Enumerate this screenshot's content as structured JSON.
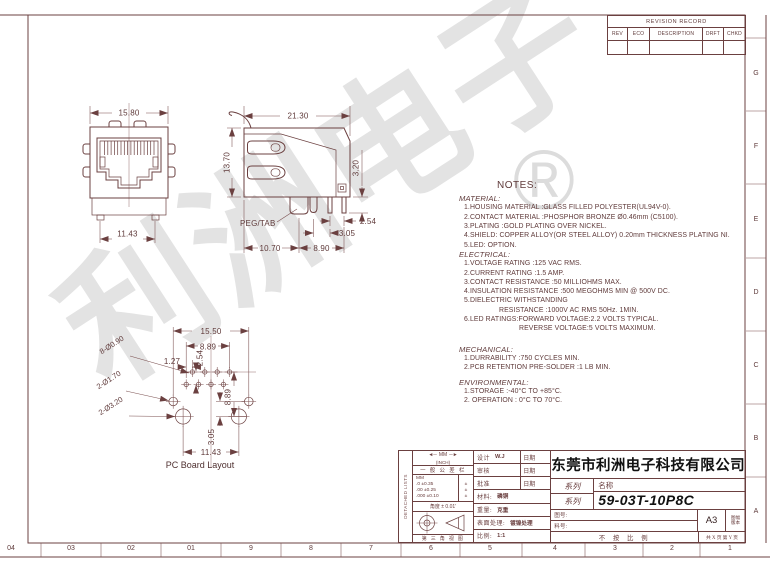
{
  "watermark": {
    "text": "利洲电子",
    "registered": "®",
    "color": "#e3e3e3"
  },
  "colors": {
    "line": "#6b4040",
    "black_text": "#111111",
    "watermark": "#e3e3e3"
  },
  "revision_table": {
    "title": "REVISION RECORD",
    "columns": [
      "REV",
      "ECO",
      "DESCRIPTION",
      "DRFT",
      "CHKD"
    ]
  },
  "border": {
    "bottom_labels": [
      "04",
      "03",
      "02",
      "01",
      "9",
      "8",
      "7",
      "6",
      "5",
      "4",
      "3",
      "2",
      "1"
    ],
    "right_labels": [
      "G",
      "F",
      "E",
      "D",
      "C",
      "B",
      "A"
    ]
  },
  "front_view": {
    "dim_width": "15.80",
    "dim_pin_span": "11.43"
  },
  "side_view": {
    "dim_depth": "21.30",
    "dim_height": "13.70",
    "dim_pin_length": "3.20",
    "dim_pin_pitch": "2.54",
    "dim_peg_to_pin": "3.05",
    "dim_peg_offset": "10.70",
    "dim_pin_row": "8.90",
    "peg_label": "PEG/TAB"
  },
  "pcb_layout": {
    "caption": "PC Board Layout",
    "dim_peg_spacing": "15.50",
    "dim_pin_row_width": "8.89",
    "dim_pin_offset": "1.27",
    "dim_row_pitch": "2.54",
    "dim_row_to_hole": "8.89",
    "dim_hole_gap": "3.05",
    "dim_shield_spacing": "11.43",
    "label_pin_holes": "8-Ø0.90",
    "label_peg_holes": "2-Ø1.70",
    "label_shield_holes": "2-Ø3.20"
  },
  "notes": {
    "title": "NOTES:",
    "material_heading": "MATERIAL:",
    "material_items": [
      "1.HOUSING  MATERIAL  :GLASS  FILLED  POLYESTER(UL94V-0).",
      "2.CONTACT  MATERIAL   :PHOSPHOR  BRONZE  Ø0.46mm  (C5100).",
      "3.PLATING  :GOLD  PLATING  OVER  NICKEL.",
      "4.SHIELD: COPPER  ALLOY(OR  STEEL  ALLOY)  0.20mm  THICKNESS  PLATING  NI.",
      "5.LED: OPTION."
    ],
    "electrical_heading": "ELECTRICAL:",
    "electrical_items": [
      "1.VOLTAGE  RATING  :125  VAC  RMS.",
      "2.CURRENT  RATING  :1.5  AMP.",
      "3.CONTACT  RESISTANCE  :50  MILLIOHMS  MAX.",
      "4.INSULATION  RESISTANCE    :500  MEGOHMS  MIN  @  500V  DC.",
      "5.DIELECTRIC  WITHSTANDING",
      "RESISTANCE  :1000V  AC  RMS  50Hz.  1MIN.",
      "6.LED  RATINGS:FORWARD  VOLTAGE:2.2  VOLTS  TYPICAL.",
      "REVERSE   VOLTAGE:5  VOLTS  MAXIMUM."
    ],
    "mechanical_heading": "MECHANICAL:",
    "mechanical_items": [
      "1.DURRABILITY :750  CYCLES  MIN.",
      "2.PCB  RETENTION  PRE-SOLDER :1  LB  MIN."
    ],
    "environmental_heading": "ENVIRONMENTAL:",
    "environmental_items": [
      "1.STORAGE      :-40°C  TO  +85°C.",
      "2. OPERATION : 0°C  TO  70°C."
    ]
  },
  "title_block": {
    "side_text": "DETACHED LISTS",
    "tolerance": {
      "header_mm": "MM",
      "header_inch": "(INCH)",
      "general": "一 般 公 差 栏",
      "sub_mm": "MM",
      "rows": [
        ".0  ±0.35",
        ".00  ±0.25",
        ".000 ±0.10"
      ],
      "pm": "±",
      "angle": "角度 ± 0.01'",
      "third_angle": "第 三 角 视 图"
    },
    "design_label": "设计",
    "designer": "W.J",
    "date_label": "日期",
    "check_label": "审核",
    "approve_label": "批准",
    "material_label": "材料:",
    "material_value": "磷铜",
    "weight_label": "重量:",
    "weight_value": "克重",
    "surface_label": "表面处理:",
    "surface_value": "镀镍处理",
    "scale_label": "比例:",
    "scale_value": "1:1",
    "company": "东莞市利洲电子科技有限公司",
    "series_label_1": "系列",
    "series_label_2": "系列",
    "name_label": "名称",
    "part_number": "59-03T-10P8C",
    "drawing_no_label": "图号:",
    "part_no_label": "料号:",
    "paper_size": "A3",
    "sheet_label": "图幅",
    "version_label": "版本",
    "not_to_scale": "不 按 比 例",
    "pages": "共 X 页  第 Y 页"
  }
}
